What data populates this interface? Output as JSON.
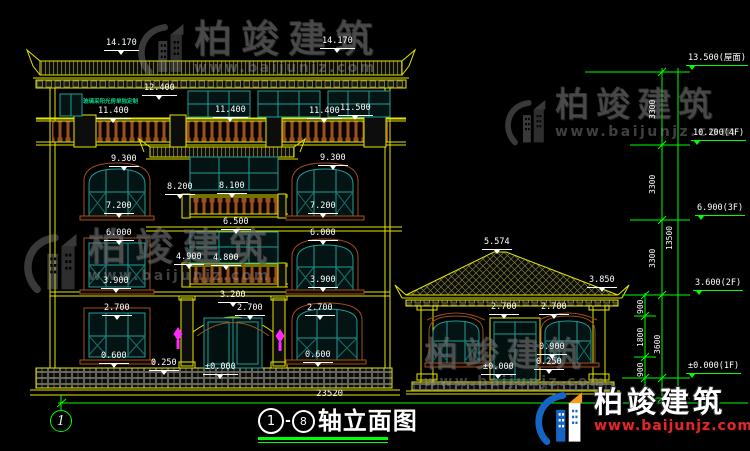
{
  "drawing": {
    "title": {
      "axis_start": "1",
      "dash": "-",
      "axis_end": "8",
      "name": "轴立面图"
    },
    "axis_bubble_label": "1",
    "overall_dim": "23520",
    "green_note": "玻璃采阳光房单独定制",
    "colors": {
      "line_yellow": "#e6e600",
      "window_teal": "#1f9e96",
      "wood_brown": "#9c4f1e",
      "dim_green": "#00ff00",
      "lamp_magenta": "#ff2aff",
      "text_white": "#ffffff",
      "note_green": "#00d587"
    },
    "level_labels": [
      {
        "text": "14.170",
        "x": 104,
        "y": 39
      },
      {
        "text": "14.170",
        "x": 320,
        "y": 37
      },
      {
        "text": "12.400",
        "x": 142,
        "y": 84
      },
      {
        "text": "11.400",
        "x": 96,
        "y": 107
      },
      {
        "text": "11.400",
        "x": 213,
        "y": 106
      },
      {
        "text": "11.400",
        "x": 307,
        "y": 107
      },
      {
        "text": "11.500",
        "x": 338,
        "y": 104
      },
      {
        "text": "9.300",
        "x": 109,
        "y": 155
      },
      {
        "text": "9.300",
        "x": 318,
        "y": 154
      },
      {
        "text": "8.200",
        "x": 165,
        "y": 183
      },
      {
        "text": "8.100",
        "x": 217,
        "y": 182
      },
      {
        "text": "7.200",
        "x": 104,
        "y": 202
      },
      {
        "text": "7.200",
        "x": 308,
        "y": 202
      },
      {
        "text": "6.500",
        "x": 221,
        "y": 218
      },
      {
        "text": "6.000",
        "x": 104,
        "y": 229
      },
      {
        "text": "6.000",
        "x": 308,
        "y": 229
      },
      {
        "text": "4.900",
        "x": 174,
        "y": 253
      },
      {
        "text": "4.800",
        "x": 211,
        "y": 254
      },
      {
        "text": "3.900",
        "x": 101,
        "y": 277
      },
      {
        "text": "3.900",
        "x": 308,
        "y": 276
      },
      {
        "text": "3.200",
        "x": 218,
        "y": 291
      },
      {
        "text": "2.700",
        "x": 102,
        "y": 304
      },
      {
        "text": "2.700",
        "x": 235,
        "y": 304
      },
      {
        "text": "2.700",
        "x": 305,
        "y": 304
      },
      {
        "text": "0.600",
        "x": 99,
        "y": 352
      },
      {
        "text": "0.600",
        "x": 303,
        "y": 351
      },
      {
        "text": "0.250",
        "x": 149,
        "y": 359
      },
      {
        "text": "±0.000",
        "x": 203,
        "y": 363
      },
      {
        "text": "5.574",
        "x": 482,
        "y": 238
      },
      {
        "text": "3.850",
        "x": 587,
        "y": 276
      },
      {
        "text": "2.700",
        "x": 489,
        "y": 303
      },
      {
        "text": "2.700",
        "x": 539,
        "y": 303
      },
      {
        "text": "0.900",
        "x": 537,
        "y": 343
      },
      {
        "text": "0.250",
        "x": 534,
        "y": 358
      },
      {
        "text": "±0.000",
        "x": 481,
        "y": 363
      }
    ],
    "right_levels": [
      {
        "text": "13.500(屋面)",
        "x": 686,
        "y": 54
      },
      {
        "text": "10.200(4F)",
        "x": 691,
        "y": 129
      },
      {
        "text": "6.900(3F)",
        "x": 695,
        "y": 204
      },
      {
        "text": "3.600(2F)",
        "x": 693,
        "y": 279
      },
      {
        "text": "±0.000(1F)",
        "x": 686,
        "y": 362
      }
    ],
    "vertical_dims": [
      {
        "text": "3300",
        "x": 649,
        "y": 119
      },
      {
        "text": "3300",
        "x": 649,
        "y": 194
      },
      {
        "text": "3300",
        "x": 649,
        "y": 268
      },
      {
        "text": "13500",
        "x": 666,
        "y": 250
      },
      {
        "text": "900",
        "x": 637,
        "y": 314
      },
      {
        "text": "1800",
        "x": 637,
        "y": 347
      },
      {
        "text": "3600",
        "x": 654,
        "y": 354
      },
      {
        "text": "900",
        "x": 637,
        "y": 377
      }
    ]
  },
  "watermark": {
    "brand": "柏竣建筑",
    "url": "www.baijunjz.com"
  },
  "logo_badge": {
    "brand": "柏竣建筑",
    "url": "www.baijunjz.com"
  }
}
